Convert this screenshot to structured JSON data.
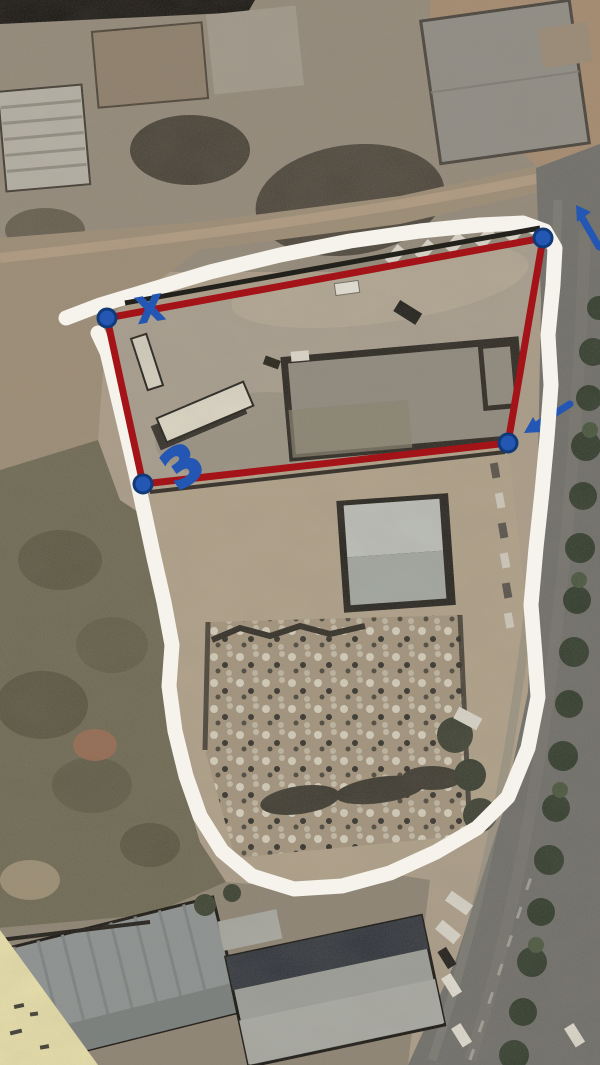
{
  "image": {
    "width": "600",
    "height": "1065",
    "kind": "annotated aerial photo of a land plot"
  },
  "palette": {
    "ground_tan": "#ab9d88",
    "dirt_brown": "#9c8c75",
    "road_asphalt": "#6e6d69",
    "scrub_olive": "#6d6852",
    "roof_gray": "#8c9292",
    "paper_corner_yellow": "#e9e1ab"
  },
  "annotations": {
    "boundary_color": "#a31318",
    "marker_color": "#2456b4",
    "marker_edge_color": "#123a78",
    "outline_color": "#f6f3ec",
    "plot_boundary": {
      "points": "107,318 543,238 508,443 143,484",
      "stroke_width": "7"
    },
    "site_outline": {
      "d": "M 66 318 L 100 305 L 150 290 L 210 272 L 280 255 L 350 241 L 420 231 L 480 225 L 523 223 L 545 231 L 555 248 L 553 285 L 548 335 L 551 385 L 547 438 L 542 492 L 536 548 L 531 605 L 535 655 L 538 697 L 528 748 L 508 797 L 477 828 L 436 852 L 390 873 L 342 886 L 294 889 L 252 876 L 222 851 L 200 816 L 186 776 L 175 731 L 169 686 L 172 645 L 164 602 L 154 558 L 145 516 L 136 474 L 126 431 L 116 389 L 107 352 L 98 333",
      "stroke_width": "15"
    },
    "corner_markers": [
      {
        "cx": "107",
        "cy": "318"
      },
      {
        "cx": "543",
        "cy": "238"
      },
      {
        "cx": "508",
        "cy": "443"
      },
      {
        "cx": "143",
        "cy": "484"
      }
    ],
    "x_mark": {
      "text": "X",
      "font_size": "34",
      "transform": "translate(150,309) rotate(-10)"
    },
    "numeral_3": {
      "text": "3",
      "font_size": "52",
      "transform": "translate(182,465) rotate(-35)"
    },
    "arrow_northeast": {
      "shaft": "M 599 247 L 581 216",
      "head": "M 576 205 L 591 212 L 577 222 Z"
    },
    "arrow_west": {
      "shaft": "M 570 404 L 535 426",
      "head": "M 524 433 L 533 417 L 542 432 Z"
    }
  }
}
